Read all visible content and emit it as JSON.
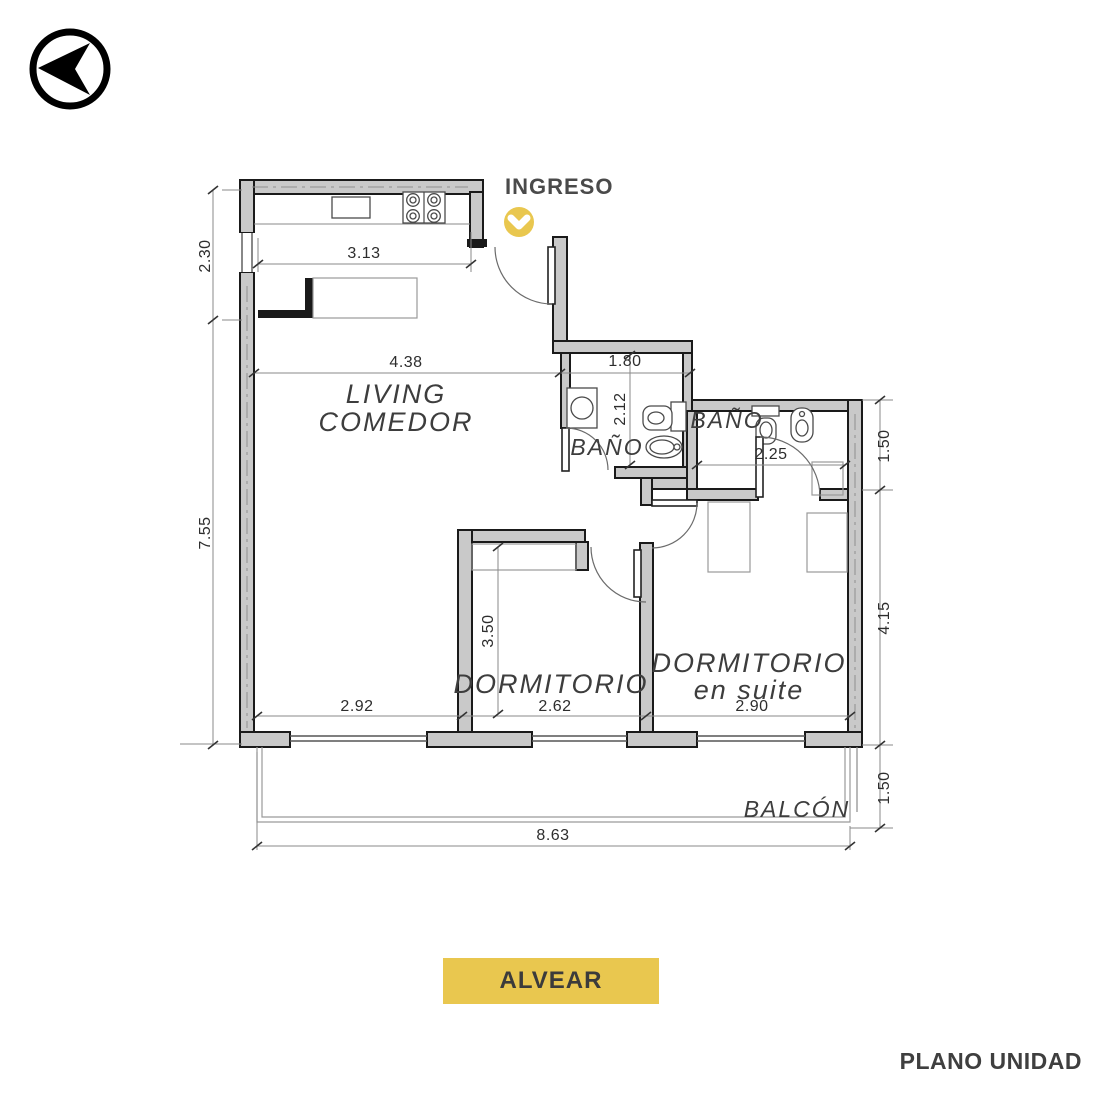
{
  "colors": {
    "accent_yellow": "#e9c74f",
    "wall_gray": "#c9c9c9",
    "ink": "#3c3c3c"
  },
  "compass": {
    "icon": "north-arrow"
  },
  "entry": {
    "label": "INGRESO",
    "icon": "chevron-down-circle"
  },
  "rooms": {
    "living": {
      "line1": "LIVING",
      "line2": "COMEDOR"
    },
    "bath1": {
      "label": "BAÑO"
    },
    "bath2": {
      "label": "BAÑO"
    },
    "bedroom1": {
      "label": "DORMITORIO"
    },
    "bedroom2": {
      "line1": "DORMITORIO",
      "line2": "en suite"
    },
    "balcony": {
      "label": "BALCÓN"
    }
  },
  "dims": {
    "left_top": "2.30",
    "left_main": "7.55",
    "kitchen_width": "3.13",
    "living_width": "4.38",
    "bath1_width": "1.80",
    "bath1_depth": "2.12",
    "bath2_width": "2.25",
    "right_top": "1.50",
    "right_main": "4.15",
    "right_balcony": "1.50",
    "bedroom1_depth": "3.50",
    "living_bottom": "2.92",
    "bedroom1_width": "2.62",
    "bedroom2_width": "2.90",
    "total_width": "8.63"
  },
  "footer": {
    "building": "ALVEAR",
    "caption": "PLANO UNIDAD"
  }
}
